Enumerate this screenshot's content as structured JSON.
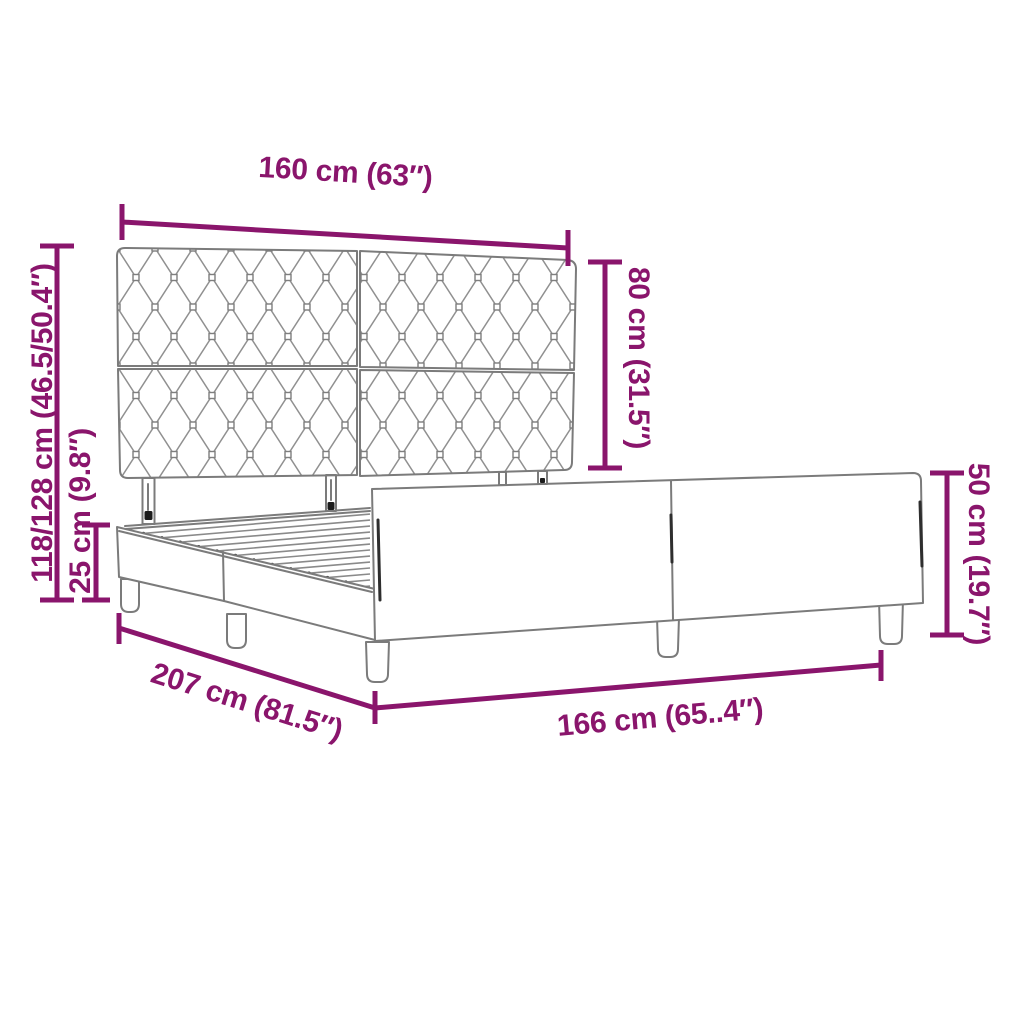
{
  "diagram": {
    "subject": "bed frame with tufted headboard dimension diagram",
    "labels": {
      "headboard_width": "160 cm (63″)",
      "headboard_height": "80 cm (31.5″)",
      "overall_height": "118/128 cm (46.5/50.4″)",
      "base_height": "25 cm (9.8″)",
      "side_height": "50 cm (19.7″)",
      "frame_length": "207 cm (81.5″)",
      "frame_width": "166 cm (65..4″)"
    },
    "colors": {
      "dimension": "#8A156C",
      "line_art": "#7b7b7b"
    }
  }
}
